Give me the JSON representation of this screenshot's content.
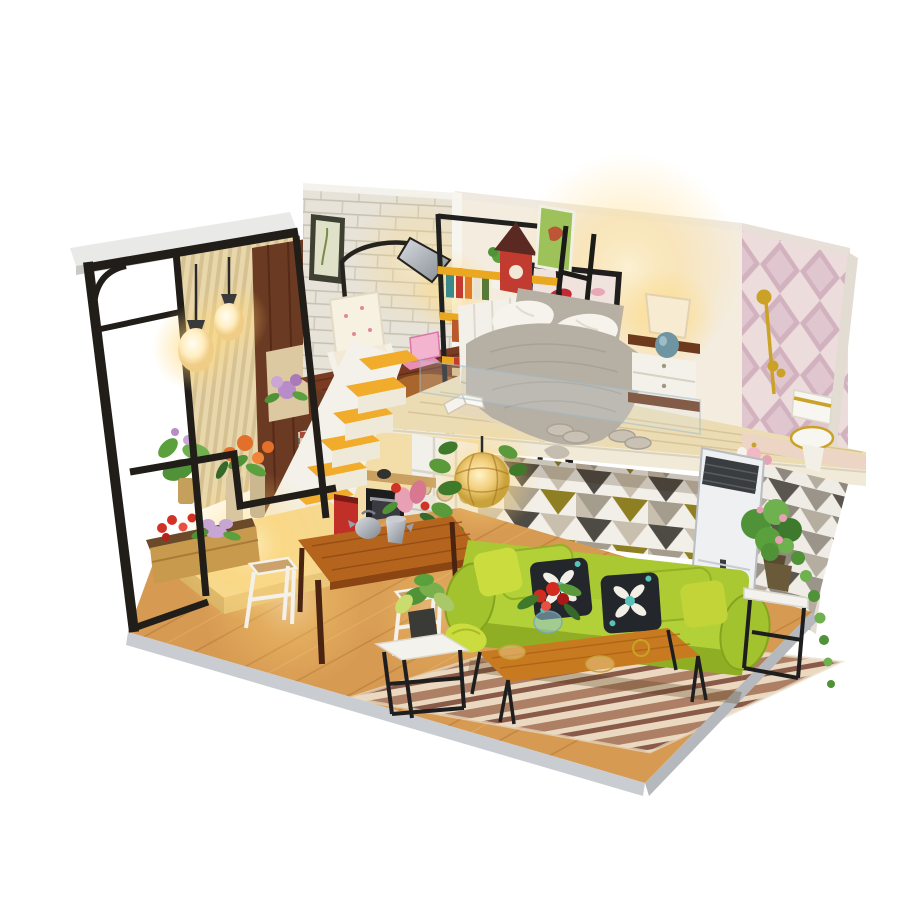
{
  "scene": {
    "subject": "Product photo of a DIY miniature loft dollhouse with lit interior on a white background",
    "background": "#ffffff"
  },
  "colors": {
    "background": "#ffffff",
    "frame_black": "#211d19",
    "roof_white": "#e9e9e7",
    "roof_edge": "#c9c9c5",
    "curtain_light": "#e4d6b0",
    "wood_wall": "#6b3a22",
    "brick_wall": "#e7e3d9",
    "bedroom_wall": "#f4ecdf",
    "diamond_bg": "#ecdcdc",
    "diamond_pink": "#d2b2bf",
    "triangle_olive": "#8f7f23",
    "triangle_gray": "#a49c8d",
    "triangle_dark": "#4e4a44",
    "stair_yellow": "#f0ac2a",
    "stair_white": "#f4f1ea",
    "study_floor": "#7a3b22",
    "deck_wood": "#ecdcb4",
    "floor_wood": "#d79a52",
    "rug_brown": "#ad8066",
    "rug_cream": "#ead9c0",
    "sofa_green": "#a9c832",
    "sofa_green_dark": "#8fae24",
    "pillow_chartreuse": "#cbdc3e",
    "pillow_black": "#23272c",
    "pillow_teal": "#57c2b8",
    "table_wood": "#b5641e",
    "coffee_table_wood": "#c87a20",
    "ac_white": "#eef0f2",
    "birdhouse_red": "#c23b30",
    "shelf_yellow": "#e9a81f",
    "glow_warm": "#ffd87a",
    "lamp_cream": "#f7ecd2",
    "blanket_gray": "#b6afa3",
    "pillow_white": "#f6f3ec",
    "nightstand_wood": "#6e3a1e",
    "plant_green": "#4f9238",
    "plant_light": "#6fb14e",
    "gold": "#c9a227",
    "flower_red": "#d13226",
    "base_gray": "#c9ccd1",
    "coffee_maker_red": "#c03028"
  }
}
